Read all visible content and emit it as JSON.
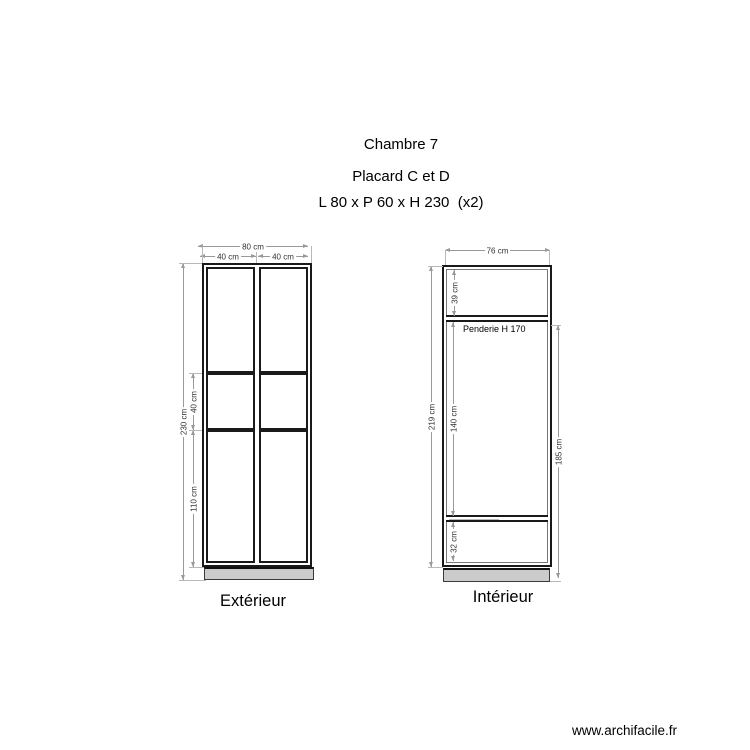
{
  "header": {
    "line1": "Chambre 7",
    "line2": "Placard C et D",
    "line3": "L 80 x P 60 x H 230  (x2)"
  },
  "exterior": {
    "label": "Extérieur",
    "dim_total_width": "80 cm",
    "dim_door_left": "40 cm",
    "dim_door_right": "40 cm",
    "dim_total_height": "230 cm",
    "dim_middle_section": "40 cm",
    "dim_bottom_section": "110 cm",
    "dim_plinth": "0 cm"
  },
  "interior": {
    "label": "Intérieur",
    "annotation": "Penderie H 170",
    "dim_width": "76 cm",
    "dim_top_section": "39 cm",
    "dim_hanging_section": "140 cm",
    "dim_bottom_section": "32 cm",
    "dim_inner_height": "219 cm",
    "dim_right_height": "185 cm"
  },
  "footer": {
    "website": "www.archifacile.fr"
  },
  "colors": {
    "cabinet_line": "#1a1a1a",
    "dimension_line": "#999999",
    "plinth_fill": "#cbcbcb",
    "text": "#000000"
  }
}
